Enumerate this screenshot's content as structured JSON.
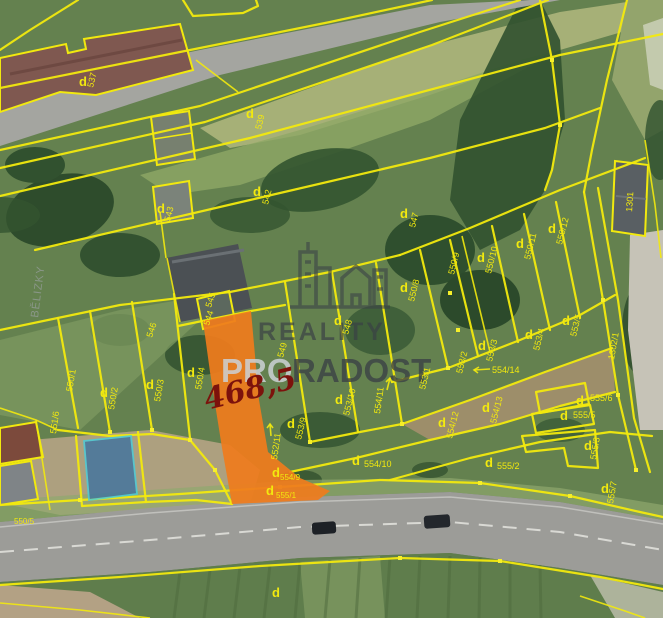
{
  "watermark": {
    "brand_top": "REALITY",
    "brand_pro": "PRO",
    "brand_radost": "RADOST"
  },
  "highlight": {
    "area_label": "468,5"
  },
  "marker_d": "d",
  "area_name": "BĚLIZKY",
  "colors": {
    "boundary_yellow": "#f2e90e",
    "highlight_orange": "#ef7c1d",
    "measure_red": "#7c120c",
    "secondary_blue": "#3f72a0",
    "secondary_border_cyan": "#43cfe0",
    "watermark_dark": "#3a4045",
    "watermark_light": "#ccd1d5"
  },
  "parcels": [
    {
      "label": "537"
    },
    {
      "label": "539"
    },
    {
      "label": "542"
    },
    {
      "label": "543"
    },
    {
      "label": "544"
    },
    {
      "label": "545"
    },
    {
      "label": "546"
    },
    {
      "label": "547"
    },
    {
      "label": "548"
    },
    {
      "label": "549"
    },
    {
      "label": "550/1"
    },
    {
      "label": "550/2"
    },
    {
      "label": "550/3"
    },
    {
      "label": "550/4"
    },
    {
      "label": "550/5"
    },
    {
      "label": "550/8"
    },
    {
      "label": "550/9"
    },
    {
      "label": "550/10"
    },
    {
      "label": "550/11"
    },
    {
      "label": "550/12"
    },
    {
      "label": "551/6"
    },
    {
      "label": "552/11"
    },
    {
      "label": "553/1"
    },
    {
      "label": "553/2"
    },
    {
      "label": "553/3"
    },
    {
      "label": "553/4"
    },
    {
      "label": "553/5"
    },
    {
      "label": "553/9"
    },
    {
      "label": "553/10"
    },
    {
      "label": "554/9"
    },
    {
      "label": "554/10"
    },
    {
      "label": "554/11"
    },
    {
      "label": "554/12"
    },
    {
      "label": "554/13"
    },
    {
      "label": "554/14"
    },
    {
      "label": "555/1"
    },
    {
      "label": "555/2"
    },
    {
      "label": "555/3"
    },
    {
      "label": "555/5"
    },
    {
      "label": "555/6"
    },
    {
      "label": "555/7"
    },
    {
      "label": "1301"
    },
    {
      "label": "1302/1"
    }
  ]
}
